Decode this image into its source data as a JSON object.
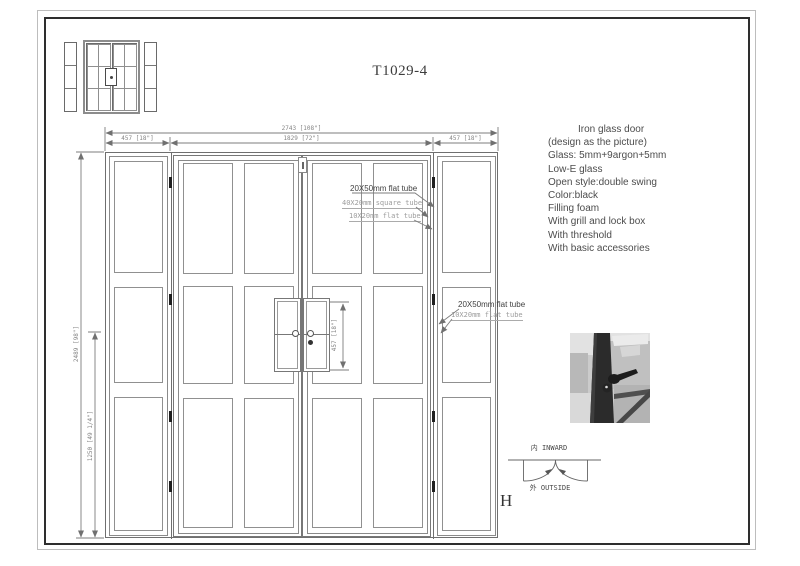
{
  "title": "T1029-4",
  "sheet_letter": "H",
  "dimensions": {
    "overall_width": "2743 [108\"]",
    "left_sidelight_width": "457 [18\"]",
    "door_width": "1829 [72\"]",
    "right_sidelight_width": "457 [18\"]",
    "overall_height": "2489 [98\"]",
    "handle_height": "1250 [49 1/4\"]",
    "lock_section_height": "457 [18\"]"
  },
  "callouts": {
    "frame_tube_top": "20X50mm flat tube",
    "square_tube_top": "40X20mm square tube",
    "flat_tube_top": "10X20mm flat tube",
    "frame_tube_side": "20X50mm flat tube",
    "flat_tube_side": "10X20mm flat tube"
  },
  "specs": {
    "lines": [
      "Iron glass door",
      "(design as the picture)",
      "Glass: 5mm+9argon+5mm",
      "Low-E glass",
      "Open style:double swing",
      "Color:black",
      "Filling foam",
      "With grill and lock box",
      "With threshold",
      "With basic  accessories"
    ]
  },
  "swing": {
    "inward_label": "内 INWARD",
    "outside_label": "外 OUTSIDE"
  },
  "colors": {
    "drawing_line": "#7d7d7d",
    "sheet_border": "#2e2e2e",
    "callout_dark": "#3f3f3f",
    "callout_gray": "#9c9c9c",
    "hinge": "#1f1f1f"
  }
}
